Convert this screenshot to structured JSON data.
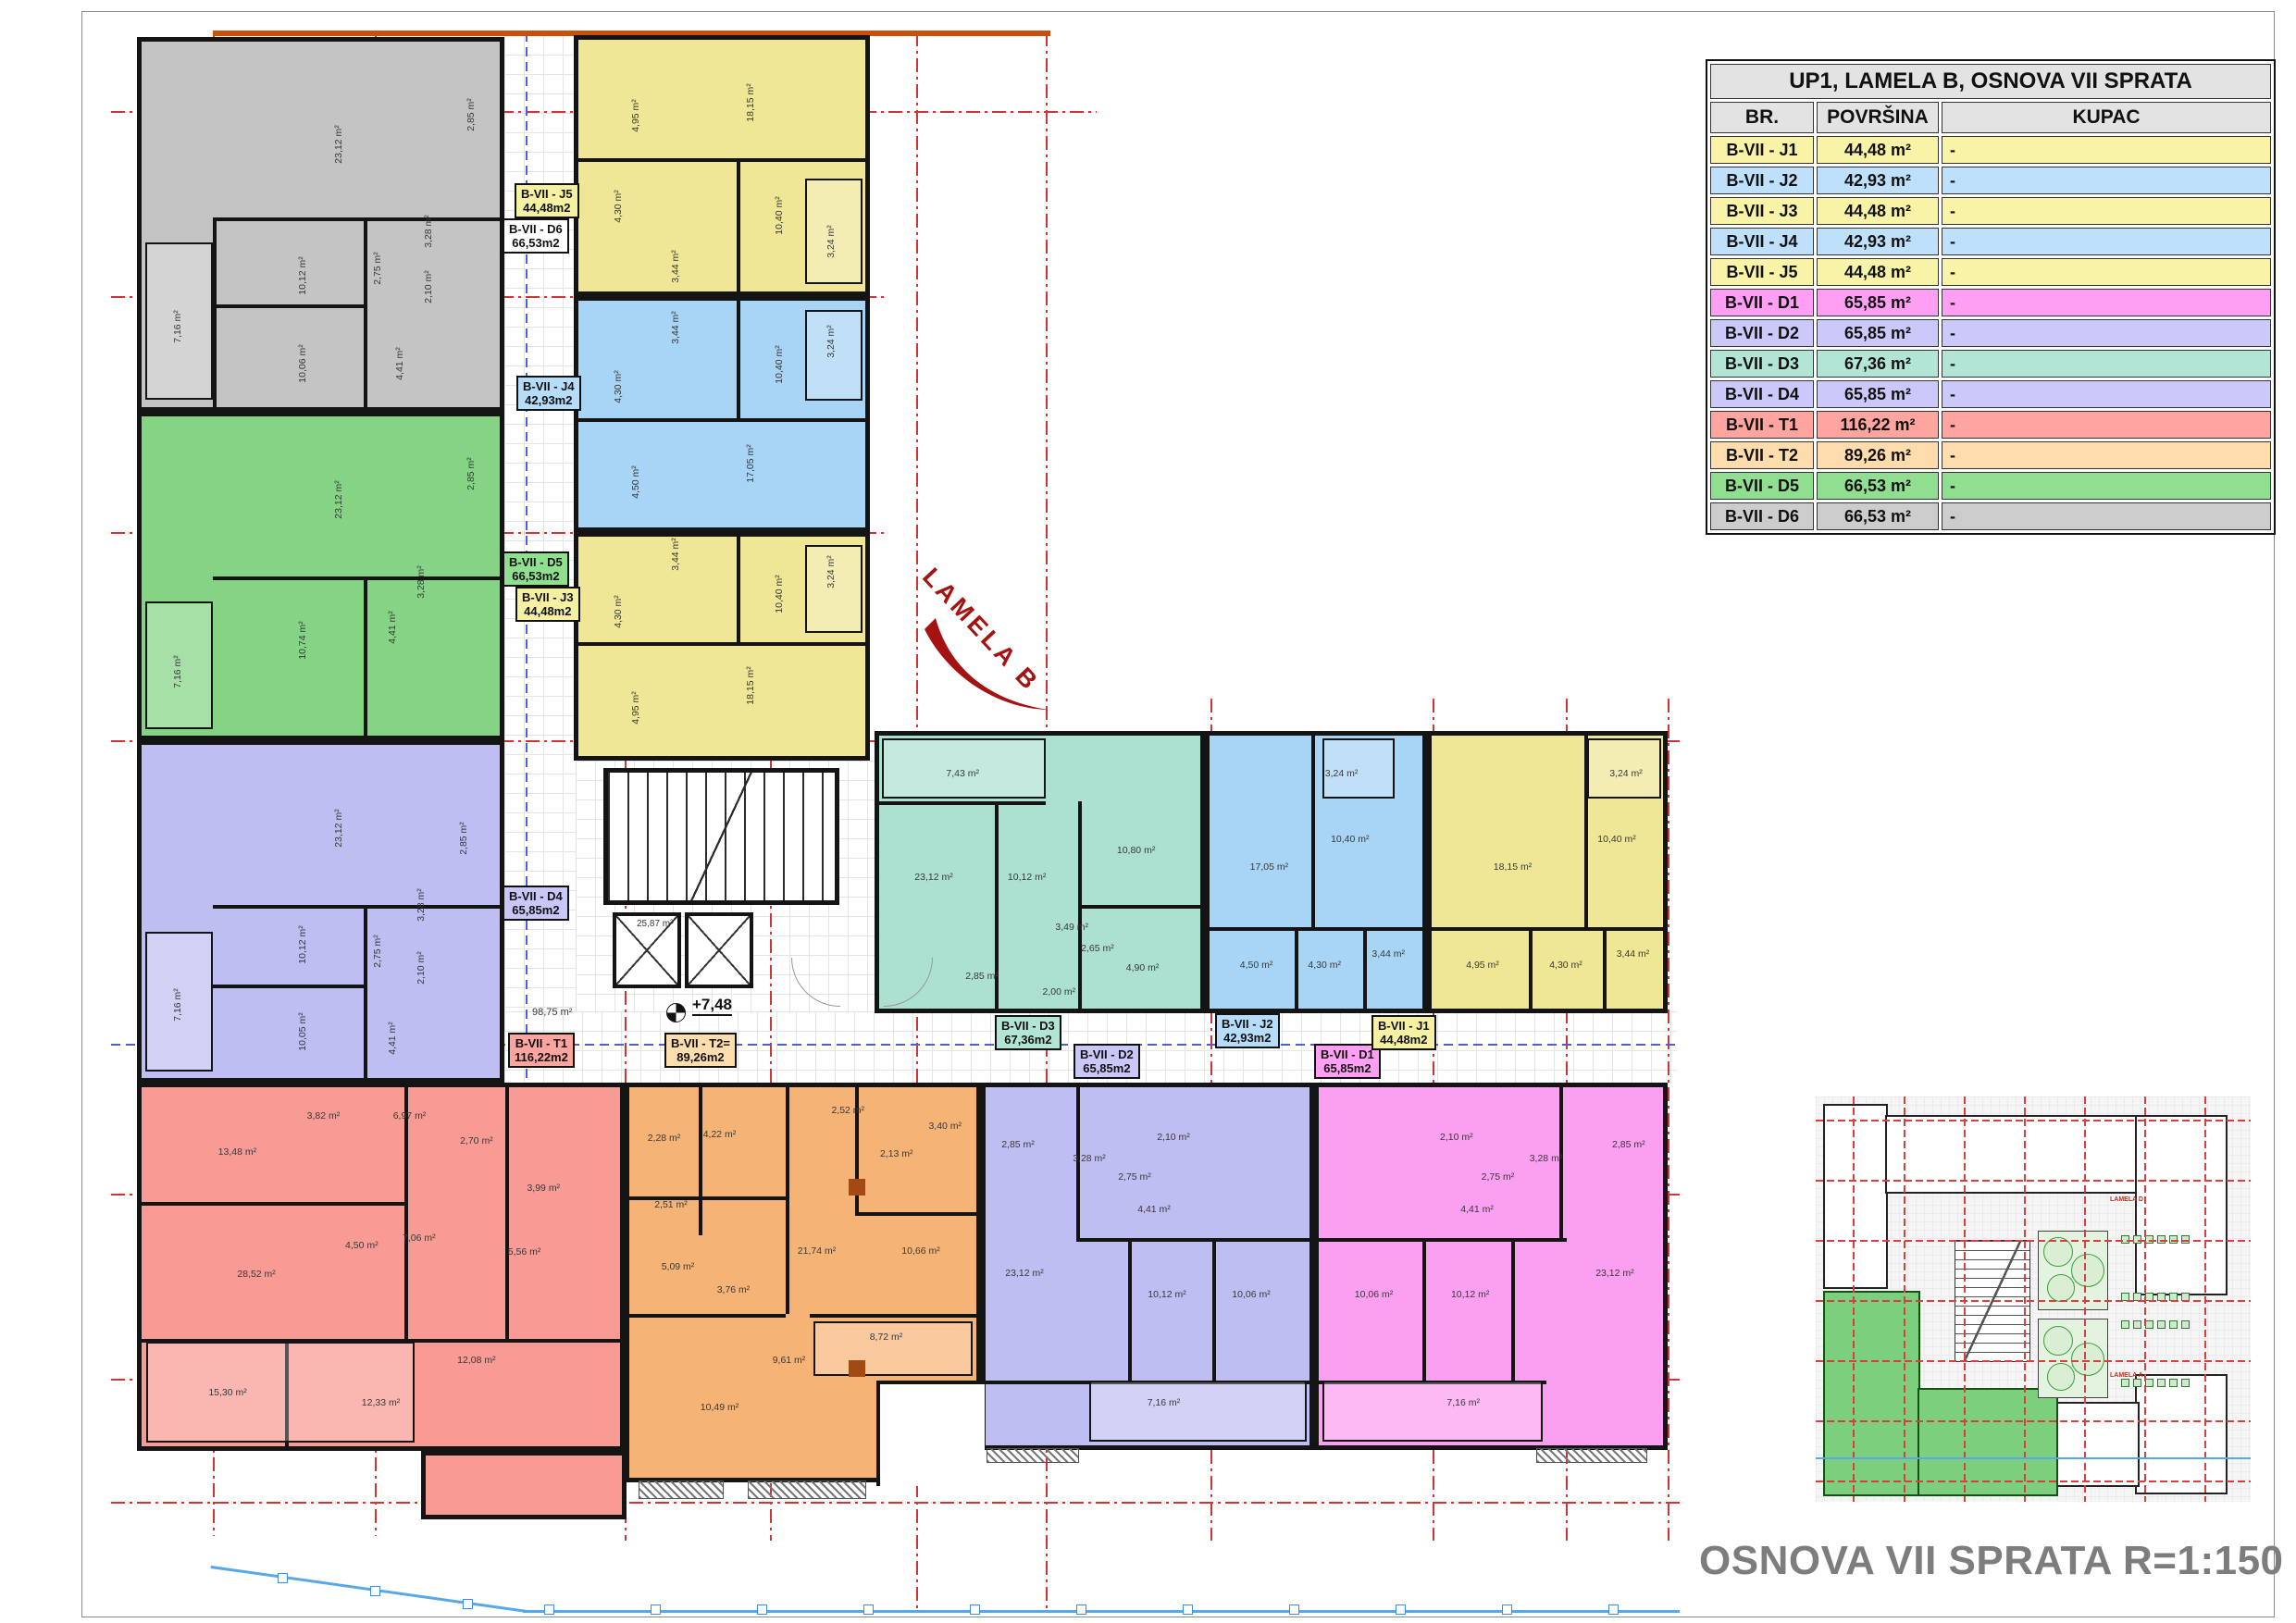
{
  "legend_table": {
    "title": "UP1, LAMELA B, OSNOVA VII SPRATA",
    "columns": [
      "BR.",
      "POVRŠINA",
      "KUPAC"
    ],
    "rows": [
      {
        "br": "B-VII - J1",
        "area": "44,48 m²",
        "kupac": "-",
        "color": "#F8F3A6"
      },
      {
        "br": "B-VII - J2",
        "area": "42,93 m²",
        "kupac": "-",
        "color": "#BEE0FA"
      },
      {
        "br": "B-VII - J3",
        "area": "44,48 m²",
        "kupac": "-",
        "color": "#F8F3A6"
      },
      {
        "br": "B-VII - J4",
        "area": "42,93 m²",
        "kupac": "-",
        "color": "#BEE0FA"
      },
      {
        "br": "B-VII - J5",
        "area": "44,48 m²",
        "kupac": "-",
        "color": "#F8F3A6"
      },
      {
        "br": "B-VII - D1",
        "area": "65,85 m²",
        "kupac": "-",
        "color": "#FF9FF3"
      },
      {
        "br": "B-VII - D2",
        "area": "65,85 m²",
        "kupac": "-",
        "color": "#CBC9F9"
      },
      {
        "br": "B-VII - D3",
        "area": "67,36 m²",
        "kupac": "-",
        "color": "#B2E5D6"
      },
      {
        "br": "B-VII - D4",
        "area": "65,85 m²",
        "kupac": "-",
        "color": "#CBC9F9"
      },
      {
        "br": "B-VII - T1",
        "area": "116,22 m²",
        "kupac": "-",
        "color": "#FFA49E"
      },
      {
        "br": "B-VII - T2",
        "area": "89,26 m²",
        "kupac": "-",
        "color": "#FFDCAE"
      },
      {
        "br": "B-VII - D5",
        "area": "66,53 m²",
        "kupac": "-",
        "color": "#90DF90"
      },
      {
        "br": "B-VII - D6",
        "area": "66,53 m²",
        "kupac": "-",
        "color": "#CCCCCC"
      }
    ]
  },
  "plan": {
    "lamela_label": "LAMELA B",
    "level_mark": "+7,48",
    "corridor_area": "98,75 m²",
    "stair_area": "25,87 m²",
    "apartments": [
      {
        "id": "d6",
        "code": "B-VII - D6",
        "area_label": "66,53m2",
        "color": "#C4C4C4",
        "label_bg": "#FFFFFF",
        "rooms": [
          "23,12 m²",
          "2,85 m²",
          "3,28 m²",
          "10,12 m²",
          "2,75 m²",
          "2,10 m²",
          "10,06 m²",
          "4,41 m²",
          "7,16 m²"
        ]
      },
      {
        "id": "d5",
        "code": "B-VII - D5",
        "area_label": "66,53m2",
        "color": "#85D485",
        "label_bg": "#8FDF8F",
        "rooms": [
          "23,12 m²",
          "2,85 m²",
          "3,28 m²",
          "10,74 m²",
          "4,41 m²",
          "7,16 m²"
        ]
      },
      {
        "id": "d4",
        "code": "B-VII - D4",
        "area_label": "65,85m2",
        "color": "#BFBEF2",
        "label_bg": "#C9C7F8",
        "rooms": [
          "23,12 m²",
          "2,85 m²",
          "3,28 m²",
          "10,12 m²",
          "2,75 m²",
          "2,10 m²",
          "10,05 m²",
          "4,41 m²",
          "7,16 m²"
        ]
      },
      {
        "id": "t1",
        "code": "B-VII - T1",
        "area_label": "116,22m2",
        "color": "#F89B95",
        "label_bg": "#FCA49E",
        "rooms": [
          "13,48 m²",
          "3,82 m²",
          "6,97 m²",
          "2,70 m²",
          "3,99 m²",
          "28,52 m²",
          "4,50 m²",
          "7,06 m²",
          "5,56 m²",
          "15,30 m²",
          "12,33 m²",
          "12,08 m²"
        ]
      },
      {
        "id": "t2",
        "code": "B-VII - T2=",
        "area_label": "89,26m2",
        "color": "#F5B476",
        "label_bg": "#FDDCAE",
        "rooms": [
          "2,28 m²",
          "4,22 m²",
          "2,52 m²",
          "2,13 m²",
          "3,40 m²",
          "2,51 m²",
          "5,09 m²",
          "3,76 m²",
          "21,74 m²",
          "10,66 m²",
          "9,61 m²",
          "10,49 m²",
          "8,72 m²"
        ]
      },
      {
        "id": "d2",
        "code": "B-VII - D2",
        "area_label": "65,85m2",
        "color": "#BFBEF2",
        "label_bg": "#C9C7F8",
        "rooms": [
          "2,85 m²",
          "23,12 m²",
          "3,28 m²",
          "2,75 m²",
          "2,10 m²",
          "4,41 m²",
          "10,12 m²",
          "10,06 m²",
          "7,16 m²"
        ]
      },
      {
        "id": "d1",
        "code": "B-VII - D1",
        "area_label": "65,85m2",
        "color": "#FB9FF0",
        "label_bg": "#FF9FF3",
        "rooms": [
          "2,85 m²",
          "23,12 m²",
          "3,28 m²",
          "2,75 m²",
          "2,10 m²",
          "4,41 m²",
          "10,12 m²",
          "10,06 m²",
          "7,16 m²"
        ]
      },
      {
        "id": "j5",
        "code": "B-VII - J5",
        "area_label": "44,48m2",
        "color": "#EFE796",
        "label_bg": "#F6F0A2",
        "rooms": [
          "18,15 m²",
          "4,95 m²",
          "4,30 m²",
          "10,40 m²",
          "3,44 m²",
          "3,24 m²"
        ]
      },
      {
        "id": "j4",
        "code": "B-VII - J4",
        "area_label": "42,93m2",
        "color": "#A8D4F5",
        "label_bg": "#B5DCF8",
        "rooms": [
          "10,40 m²",
          "3,44 m²",
          "4,30 m²",
          "17,05 m²",
          "4,50 m²",
          "3,24 m²"
        ]
      },
      {
        "id": "j3",
        "code": "B-VII - J3",
        "area_label": "44,48m2",
        "color": "#EFE796",
        "label_bg": "#F6F0A2",
        "rooms": [
          "10,40 m²",
          "3,24 m²",
          "4,30 m²",
          "3,44 m²",
          "18,15 m²",
          "4,95 m²"
        ]
      },
      {
        "id": "d3",
        "code": "B-VII - D3",
        "area_label": "67,36m2",
        "color": "#ACE1D1",
        "label_bg": "#B2E5D6",
        "rooms": [
          "7,43 m²",
          "23,12 m²",
          "10,12 m²",
          "3,49 m²",
          "2,85 m²",
          "10,80 m²",
          "2,65 m²",
          "4,90 m²",
          "2,00 m²"
        ]
      },
      {
        "id": "j2",
        "code": "B-VII - J2",
        "area_label": "42,93m2",
        "color": "#A8D4F5",
        "label_bg": "#B5DCF8",
        "rooms": [
          "3,24 m²",
          "10,40 m²",
          "17,05 m²",
          "4,50 m²",
          "4,30 m²",
          "3,44 m²"
        ]
      },
      {
        "id": "j1",
        "code": "B-VII - J1",
        "area_label": "44,48m2",
        "color": "#EFE796",
        "label_bg": "#F6F0A2",
        "rooms": [
          "3,24 m²",
          "10,40 m²",
          "18,15 m²",
          "4,95 m²",
          "4,30 m²",
          "3,44 m²"
        ]
      }
    ]
  },
  "site_plan": {
    "labels": [
      "LAMELA D",
      "LAMELA A"
    ]
  },
  "title_block": "OSNOVA VII SPRATA R=1:150"
}
